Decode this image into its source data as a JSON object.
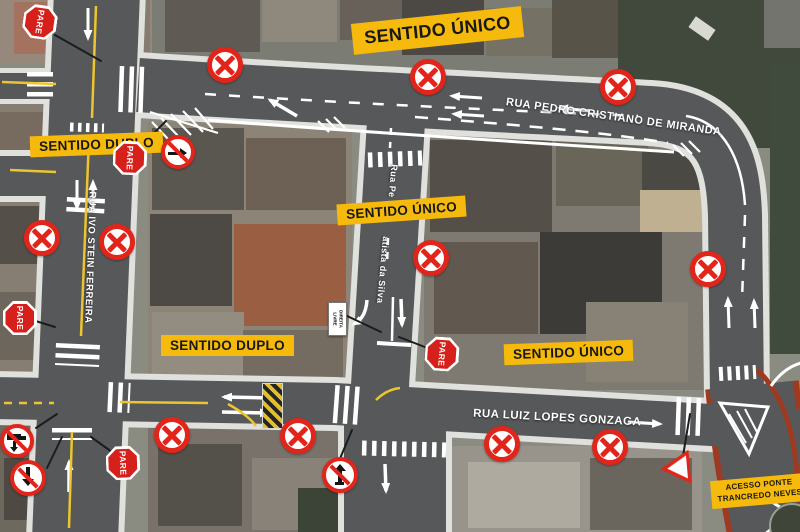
{
  "colors": {
    "label_bg": "#F5BA0C",
    "label_text": "#181818",
    "sign_red": "#E1251B",
    "road_fill": "#57585A",
    "road_casing": "#E0E0DD",
    "access_road_border": "#9E3A22",
    "marking_white": "#FFFFFF",
    "marking_yellow": "#EDC52F"
  },
  "labels": {
    "sentido_unico": "SENTIDO ÚNICO",
    "sentido_duplo": "SENTIDO DUPLO",
    "acesso_ponte": [
      "ACESSO PONTE",
      "TRANCREDO NEVES"
    ]
  },
  "streets": {
    "rua_pedro_cristiano": "RUA PEDRO CRISTIANO DE MIRANDA",
    "rua_ivo_stein": "RUA IVO STEIN FERREIRA",
    "rua_batista_upper": "Rua Pe",
    "rua_batista_lower": "atista da Silva",
    "rua_luiz_lopes": "RUA LUIZ LOPES GONZAGA"
  },
  "signs": {
    "stop": "PARE",
    "direita_livre": [
      "DIREITA",
      "LIVRE"
    ]
  }
}
